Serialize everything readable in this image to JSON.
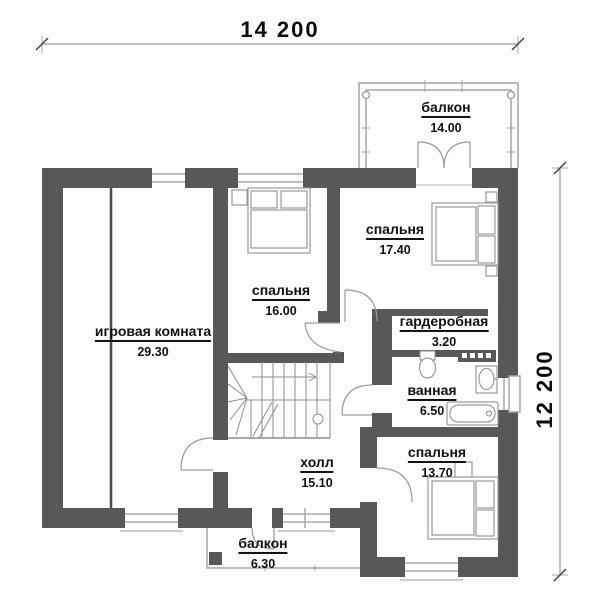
{
  "plan": {
    "dimensions": {
      "width_label": "14 200",
      "height_label": "12 200"
    },
    "rooms": [
      {
        "id": "balcony-top",
        "name": "балкон",
        "area": "14.00"
      },
      {
        "id": "bedroom-17",
        "name": "спальня",
        "area": "17.40"
      },
      {
        "id": "bedroom-16",
        "name": "спальня",
        "area": "16.00"
      },
      {
        "id": "playroom",
        "name": "игровая комната",
        "area": "29.30"
      },
      {
        "id": "wardrobe",
        "name": "гардеробная",
        "area": "3.20"
      },
      {
        "id": "bathroom",
        "name": "ванная",
        "area": "6.50"
      },
      {
        "id": "hall",
        "name": "холл",
        "area": "15.10"
      },
      {
        "id": "bedroom-13",
        "name": "спальня",
        "area": "13.70"
      },
      {
        "id": "balcony-bottom",
        "name": "балкон",
        "area": "6.30"
      }
    ],
    "colors": {
      "wall": "#585858",
      "opening": "#ffffff",
      "window_line": "#a8a8a8",
      "railing_line": "#a5a5a5",
      "door_line": "#9b9b9b",
      "furniture_line": "#9a9a9a",
      "stairs_line": "#8f8f8f",
      "dimension_line": "#555555",
      "text": "#111111"
    }
  }
}
